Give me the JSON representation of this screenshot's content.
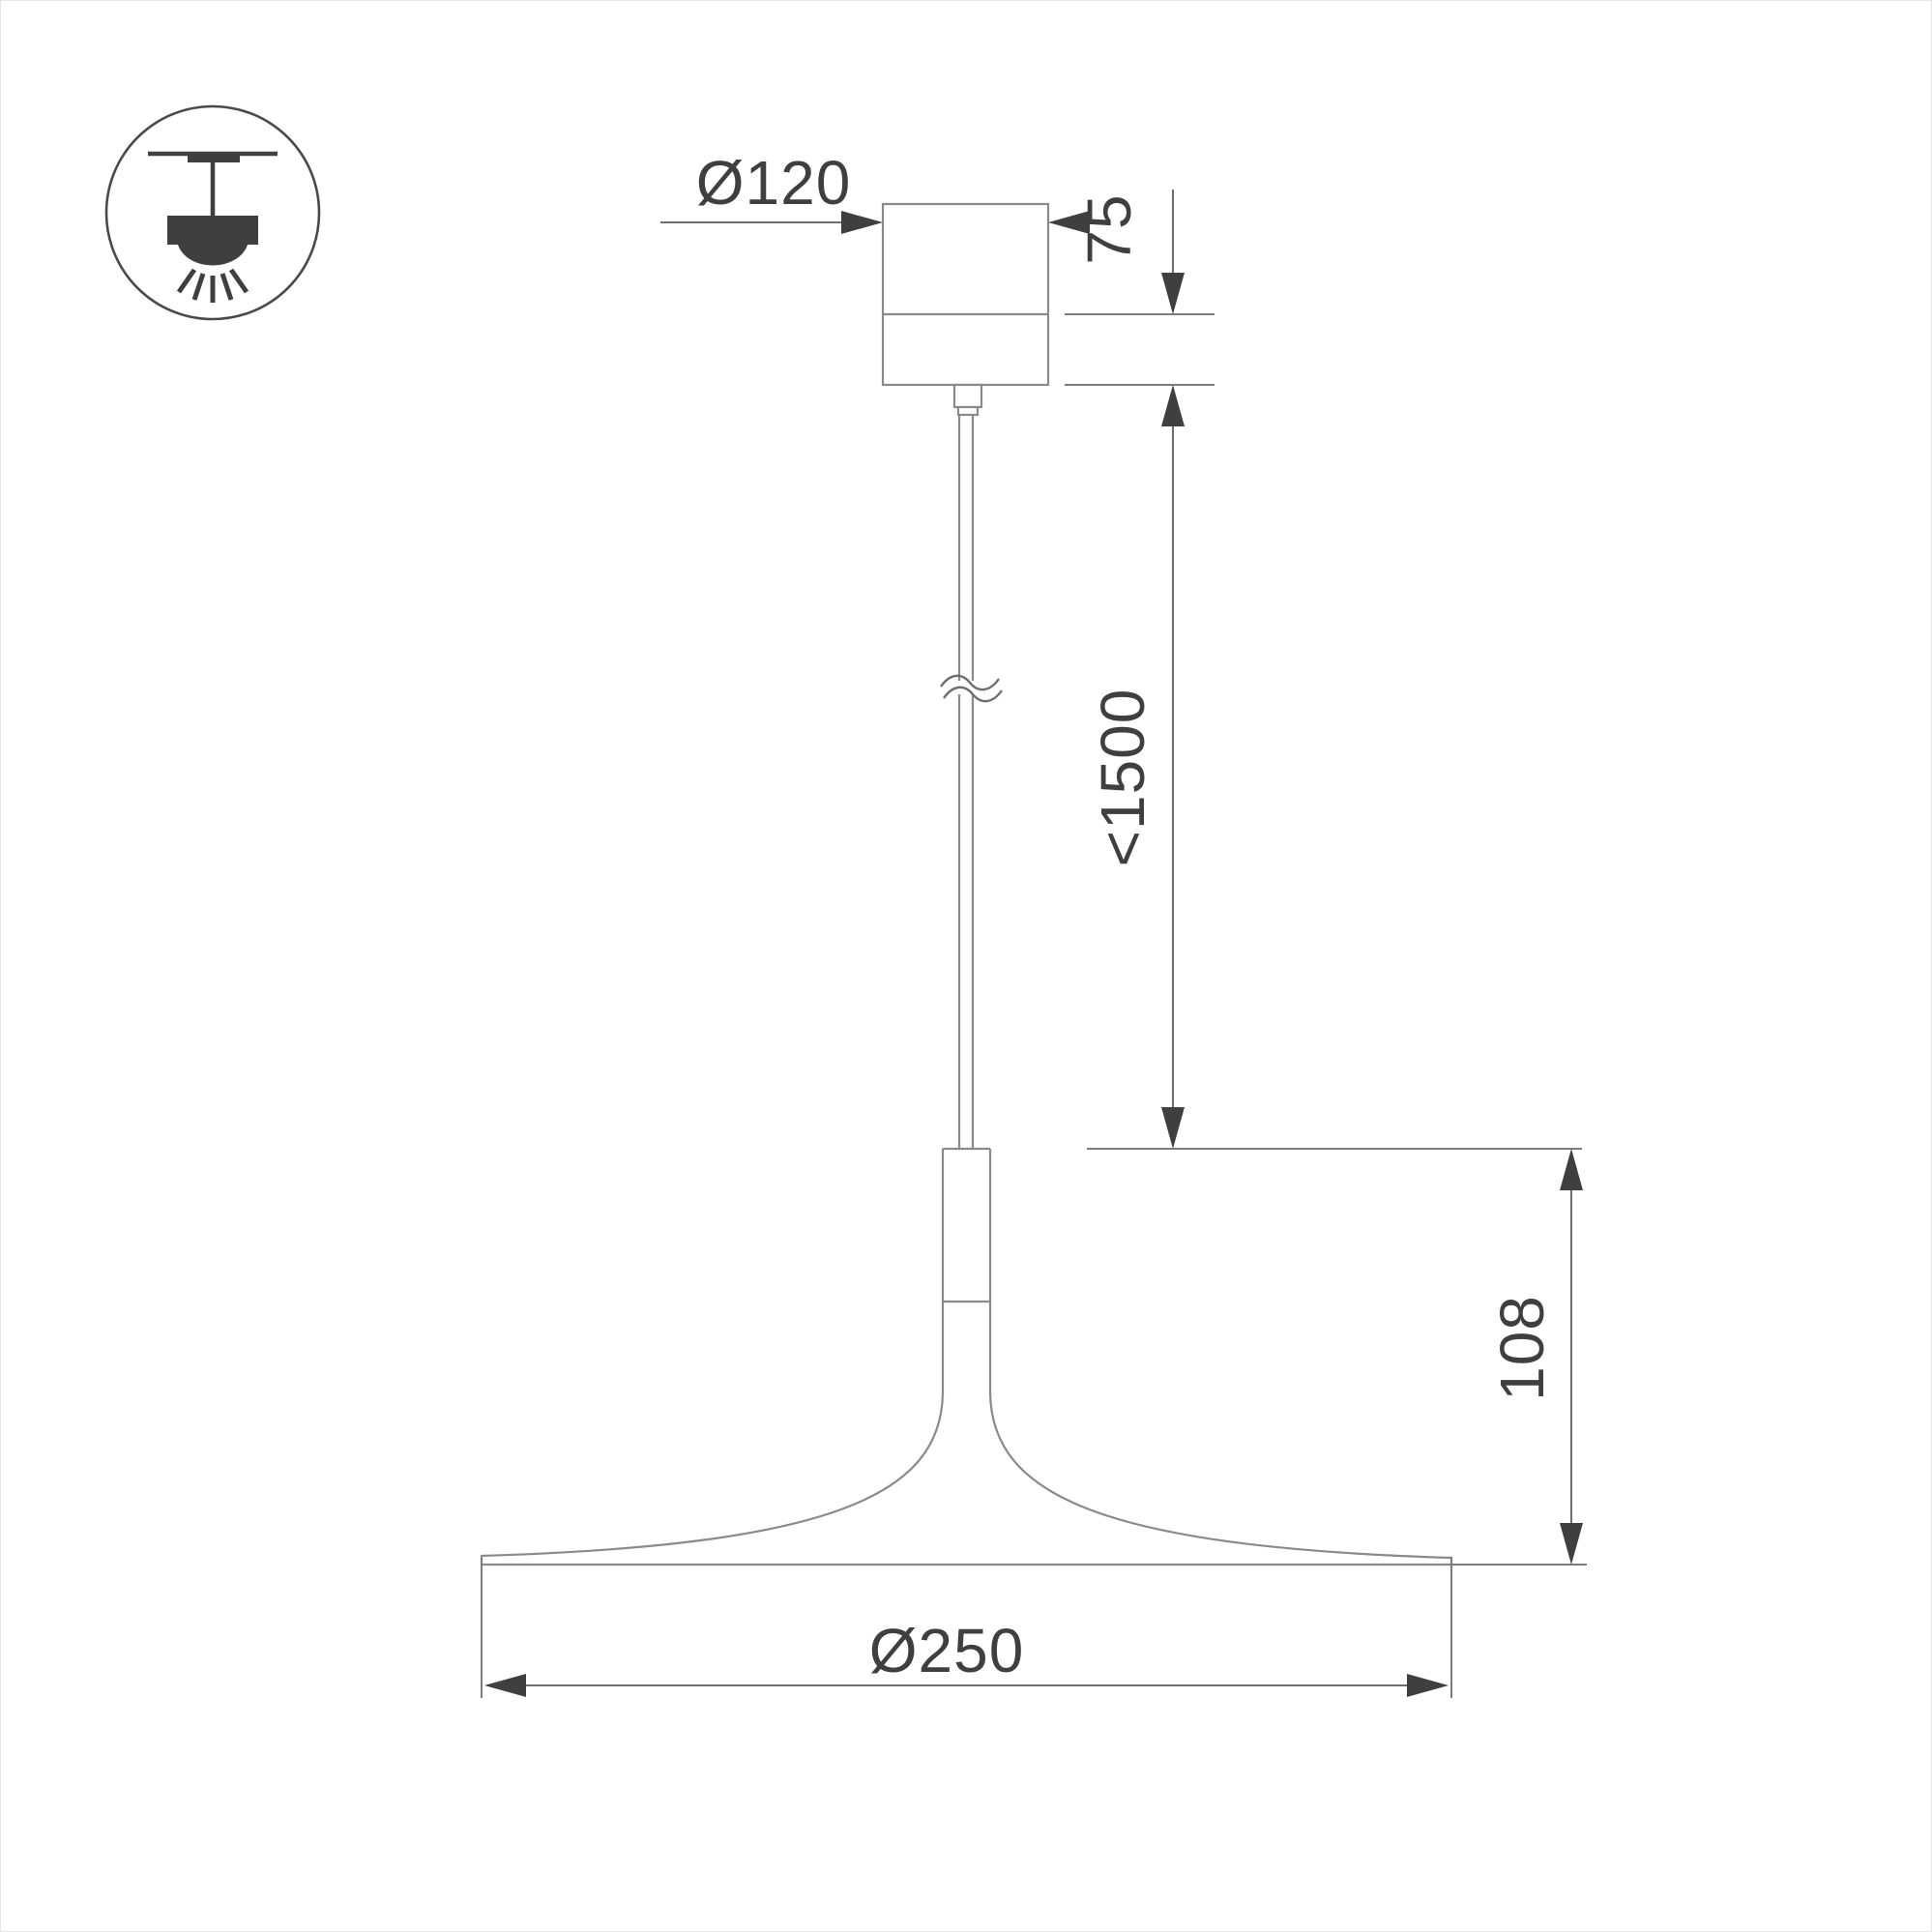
{
  "drawing": {
    "type": "pendant luminaire dimension drawing",
    "labels": {
      "canopy_diameter": "Ø120",
      "canopy_height": "75",
      "suspension_length": "<1500",
      "head_height": "108",
      "shade_diameter": "Ø250"
    },
    "colors": {
      "background": "#ffffff",
      "product_outline": "#8a8a8a",
      "dimension_lines": "#6f6f6f",
      "arrows_and_text": "#3f3f3f"
    },
    "icon": "pendant-lamp-mounting-icon"
  }
}
